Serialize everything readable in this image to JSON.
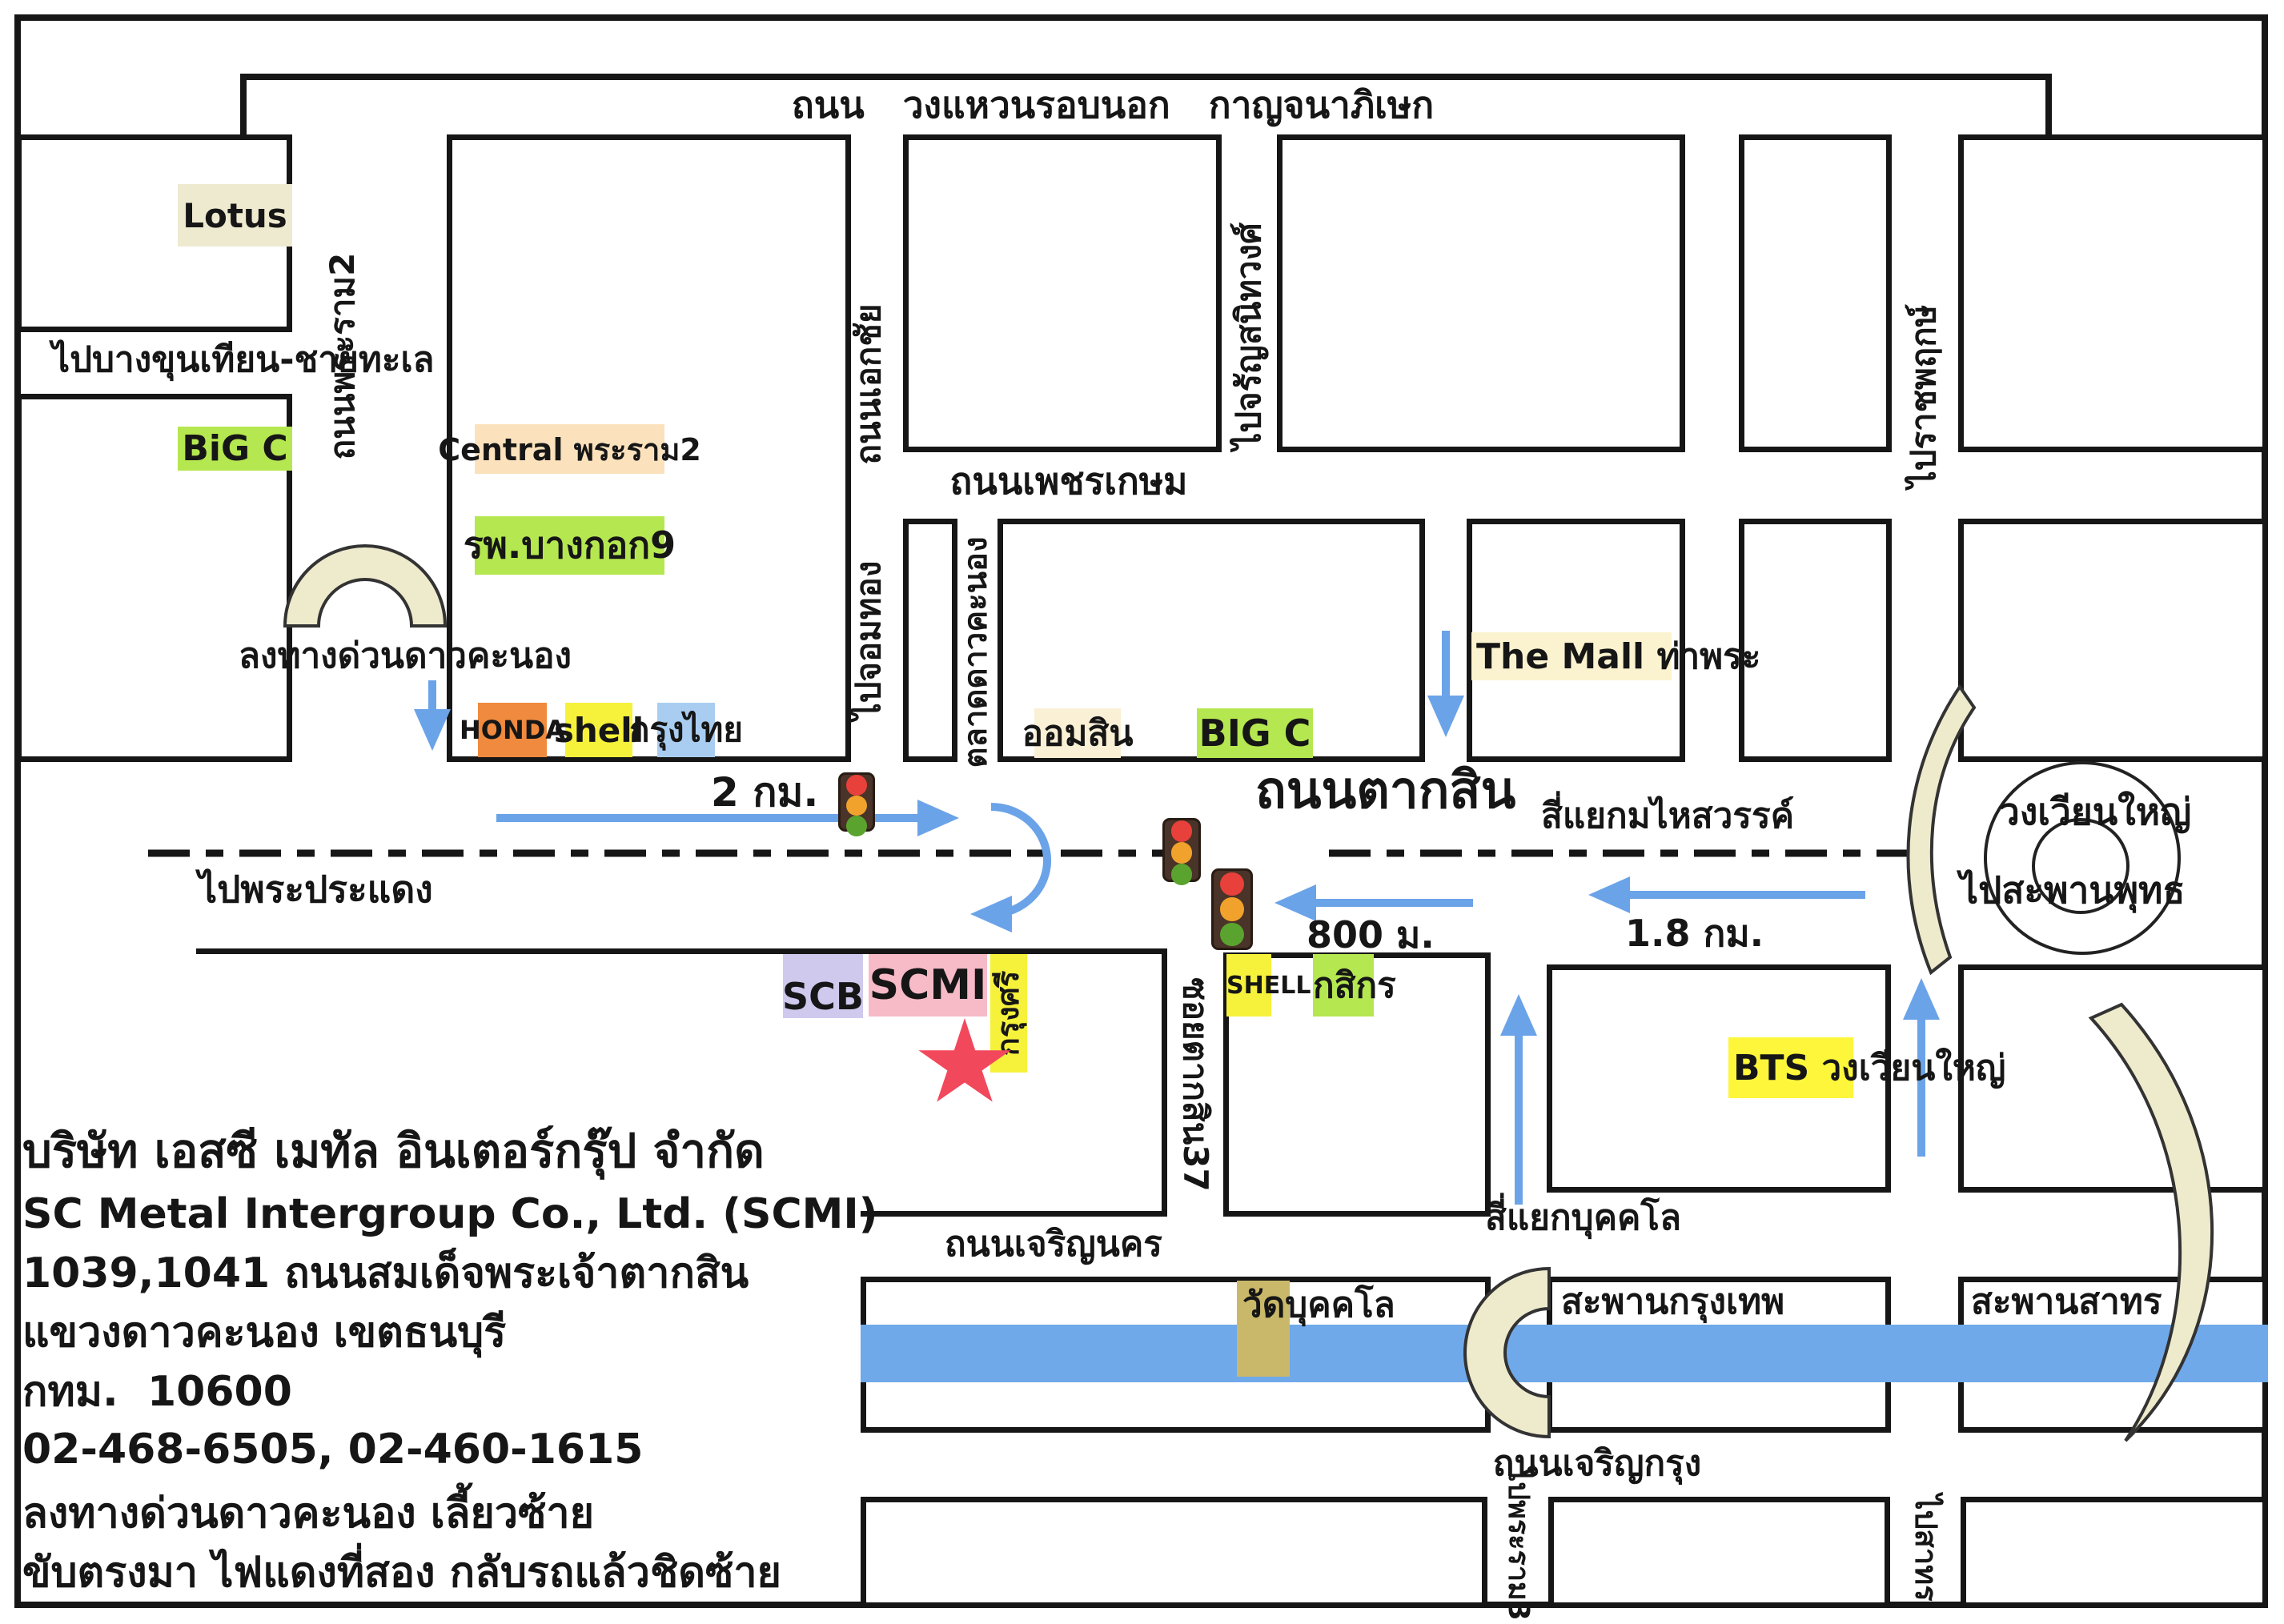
{
  "roads": {
    "outer_ring": "ถนน   วงแหวนรอบนอก   กาญจนาภิเษก",
    "rama2": "ถนนพระราม2",
    "ekkachai": "ถนนเอกชัย",
    "phetkasem": "ถนนเพชรเกษม",
    "taksin": "ถนนตากสิน",
    "charoen_nakhon": "ถนนเจริญนคร",
    "charoen_krung": "ถนนเจริญกรุง",
    "soi_taksin37": "ซอยตากสิน37",
    "talat_dao_khanong": "ตลาดดาวคะนอง"
  },
  "destinations": {
    "bang_khun_thian": "ไปบางขุนเทียน-ชายทะเล",
    "chom_thong": "ไปจอมทอง",
    "charan_sanitwong": "ไปจรัญสนิทวงศ์",
    "ratchaphruek": "ไปราชพฤกษ์",
    "phra_pradaeng": "ไปพระประแดง",
    "saphan_phut": "ไปสะพานพุทธ",
    "rama3": "ไปพระราม3",
    "sathorn": "ไปสาทร"
  },
  "junctions": {
    "mahaisawan": "สี่แยกมไหสวรรค์",
    "bukkhalo": "สี่แยกบุคคโล",
    "wongwian_yai": "วงเวียนใหญ่",
    "expressway_exit": "ลงทางด่วนดาวคะนอง"
  },
  "landmarks": {
    "lotus": "Lotus",
    "big_c_rama2": "BiG C",
    "central_rama2": "Central พระราม2",
    "bangkok9_hospital": "รพ.บางกอก9",
    "honda": "HONDA",
    "shell_rama2": "shell",
    "krungthai_bank": "กรุงไทย",
    "aomsin_bank": "ออมสิน",
    "big_c_taksin": "BIG C",
    "the_mall_thapra": "The Mall ท่าพระ",
    "scb_bank": "SCB",
    "scmi": "SCMI",
    "krungsri_bank": "กรุงศรี",
    "shell_taksin": "SHELL",
    "kasikorn_bank": "กสิกร",
    "bts_wongwian_yai": "BTS วงเวียนใหญ่",
    "wat_bukkhalo": "วัดบุคคโล",
    "krungthep_bridge": "สะพานกรุงเทพ",
    "sathorn_bridge": "สะพานสาทร"
  },
  "distances": {
    "straight_2km": "2 กม.",
    "after_uturn_800m": "800 ม.",
    "wongwianyai_1_8km": "1.8 กม."
  },
  "company": {
    "name_th": "บริษัท เอสซี เมทัล อินเตอร์กรุ๊ป จำกัด",
    "name_en": "SC Metal Intergroup Co., Ltd. (SCMI)",
    "address1": "1039,1041 ถนนสมเด็จพระเจ้าตากสิน",
    "address2": "แขวงดาวคะนอง เขตธนบุรี",
    "city_postcode": "กทม.  10600",
    "phones": "02-468-6505, 02-460-1615"
  },
  "directions_note": {
    "line1": "ลงทางด่วนดาวคะนอง เลี้ยวซ้าย",
    "line2": "ขับตรงมา ไฟแดงที่สอง กลับรถแล้วชิดซ้าย"
  },
  "palette": {
    "road_line": "#161616",
    "river_blue": "#6fa9e9",
    "arrow_blue": "#6ba3e8",
    "ramp_beige": "#eeeacc",
    "green_highlight": "#b5e750",
    "yellow_highlight": "#f6f13b",
    "bts_yellow": "#fdf63b",
    "orange_highlight": "#f08a3e",
    "blue_highlight": "#a9cdf1",
    "peach_highlight": "#fbe2bd",
    "pink_highlight": "#f7bac7",
    "lavender_highlight": "#cfc9ee",
    "cream_highlight": "#faf0d5",
    "beige_highlight": "#eeead0",
    "tan_highlight": "#c9b869",
    "star_red": "#f2485c"
  }
}
